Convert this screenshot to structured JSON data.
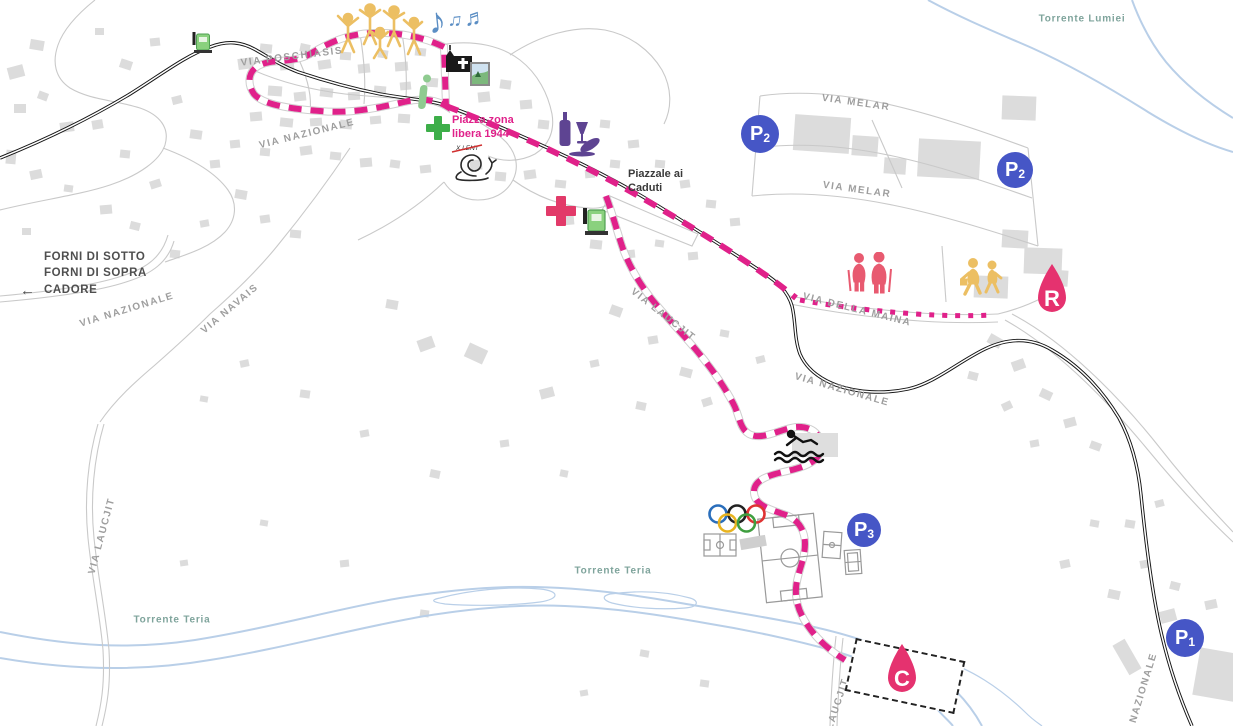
{
  "colors": {
    "route_pink": "#e0218a",
    "marker_pink": "#e5326f",
    "parking_blue": "#4656c6",
    "river_blue": "#b9cfe8",
    "building_gray": "#dcdcdc",
    "street_gray": "#9e9e9e",
    "river_text": "#7fa49c"
  },
  "street_labels": [
    {
      "text": "VIA POSCHIASIS"
    },
    {
      "text": "VIA NAZIONALE"
    },
    {
      "text": "VIA NAZIONALE"
    },
    {
      "text": "VIA NAVAIS"
    },
    {
      "text": "VIA LAUCJIT"
    },
    {
      "text": "VIA LAUCJIT"
    },
    {
      "text": "VIA LAUCJIT"
    },
    {
      "text": "VIA MELAR"
    },
    {
      "text": "VIA MELAR"
    },
    {
      "text": "VIA DELLA MAINA"
    },
    {
      "text": "VIA NAZIONALE"
    },
    {
      "text": "VIA NAZIONALE"
    }
  ],
  "river_labels": [
    {
      "text": "Torrente Lumiei"
    },
    {
      "text": "Torrente Teria"
    },
    {
      "text": "Torrente Teria"
    }
  ],
  "direction_sign": {
    "arrow": "←",
    "lines": [
      "FORNI DI SOTTO",
      "FORNI DI SOPRA",
      "CADORE"
    ]
  },
  "places": {
    "piazza": {
      "line1": "Piazza zona",
      "line2": "libera 1944"
    },
    "piazzale": {
      "line1": "Piazzale ai",
      "line2": "Caduti"
    }
  },
  "markers": {
    "parking": [
      {
        "label": "P",
        "sub": "2"
      },
      {
        "label": "P",
        "sub": "2"
      },
      {
        "label": "P",
        "sub": "3"
      },
      {
        "label": "P",
        "sub": "1"
      }
    ],
    "refreshment_point": {
      "label": "R"
    },
    "camper_area": {
      "label": "C"
    }
  },
  "icons": {
    "music_notes": [
      "♪",
      "♫",
      "♬"
    ],
    "snail_sign": "X LENT"
  }
}
